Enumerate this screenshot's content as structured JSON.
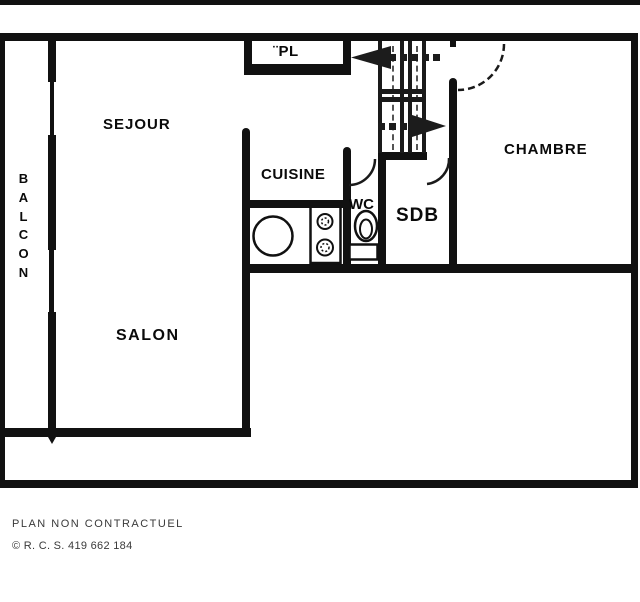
{
  "rooms": {
    "sejour": "SEJOUR",
    "balcon": "BALCON",
    "pl": "¨PL",
    "cuisine": "CUISINE",
    "wc": "WC",
    "sdb": "SDB",
    "chambre": "CHAMBRE",
    "salon": "SALON"
  },
  "footer": {
    "disclaimer": "PLAN NON CONTRACTUEL",
    "rcs": "© R. C. S. 419 662 184"
  },
  "colors": {
    "wall": "#111111",
    "background": "#ffffff",
    "label_text": "#0a0a0a",
    "footer_text": "#3a3a3a"
  }
}
